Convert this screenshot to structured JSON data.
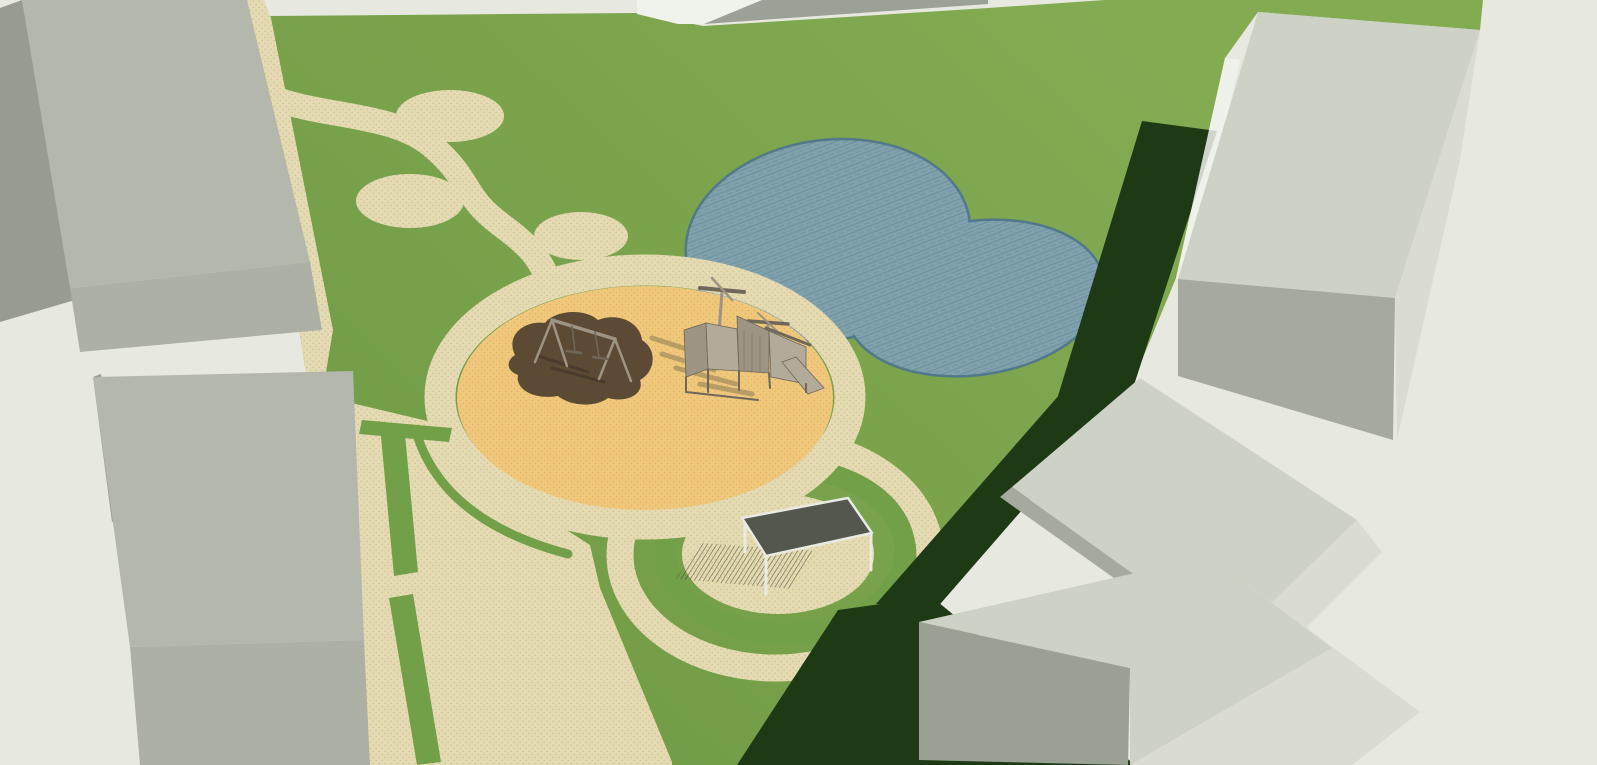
{
  "meta": {
    "title": "3D landscape render of a park and playground site plan",
    "view": "aerial perspective render, no UI chrome"
  },
  "colors": {
    "background": "#e7e9e1",
    "grass_light": "#83ab52",
    "grass_dark": "#6f9a45",
    "grass_mid": "#72a048",
    "shadow_green": "#1d3a15",
    "plaza_base": "#e5dbb3",
    "plaza_dot": "#d2c597",
    "sand_base": "#efc87c",
    "sand_dot": "#e0b164",
    "sand_shadow": "#a28a5c",
    "mulch": "#5d4a34",
    "mulch_shadow": "#46372a",
    "water_base": "#81a1ad",
    "water_line": "#6e93a0",
    "water_edge": "#527989",
    "bldgL_top": "#b4b7ac",
    "bldgL_band": "#adb0a5",
    "bldgL_dark": "#979b90",
    "bldgR_top": "#ced1c5",
    "bldgR_light": "#dadcd1",
    "bldgR_dark": "#a5a99e",
    "bldgF_side": "#9aa094",
    "white_strip": "#f0f2ec",
    "gray_strip": "#9ba197",
    "pergola_roof": "#54574d",
    "pergola_frame": "#e9ebe3",
    "hatch": "#3a3d32",
    "wood": "#9d9484",
    "wood_dark": "#6e675a",
    "wood_light": "#b3ab9a"
  },
  "scene": {
    "ground_features": [
      {
        "id": "lawn",
        "label": "park lawn"
      },
      {
        "id": "paved-plaza",
        "label": "paved plaza and entry path along west edge"
      },
      {
        "id": "winding-path",
        "label": "S-curved path with three elliptical pads"
      },
      {
        "id": "pond",
        "label": "two-lobed pond"
      },
      {
        "id": "sand-playground",
        "label": "circular sand play area with paved ring"
      },
      {
        "id": "mulch-patch",
        "label": "organic mulch patch under swing set"
      },
      {
        "id": "pergola-rings",
        "label": "concentric paving and lawn rings around pergola"
      },
      {
        "id": "hedge-strips",
        "label": "dashed green planting strips on plaza"
      },
      {
        "id": "shadows",
        "label": "dark green cast shadows from buildings"
      }
    ],
    "equipment": [
      {
        "id": "swing-set",
        "label": "A-frame double swing"
      },
      {
        "id": "climbing-structure",
        "label": "wooden play structure with rotor masts and slide"
      },
      {
        "id": "pergola",
        "label": "flat-roof shelter with white posts"
      }
    ],
    "buildings": [
      {
        "id": "building-northwest",
        "label": "block west of entry path (top left)"
      },
      {
        "id": "building-southwest",
        "label": "block along plaza (bottom left)"
      },
      {
        "id": "building-northeast",
        "label": "long block on east side (top right)"
      },
      {
        "id": "building-east",
        "label": "block on east side (middle right)"
      },
      {
        "id": "building-southeast",
        "label": "block at bottom right"
      }
    ]
  }
}
